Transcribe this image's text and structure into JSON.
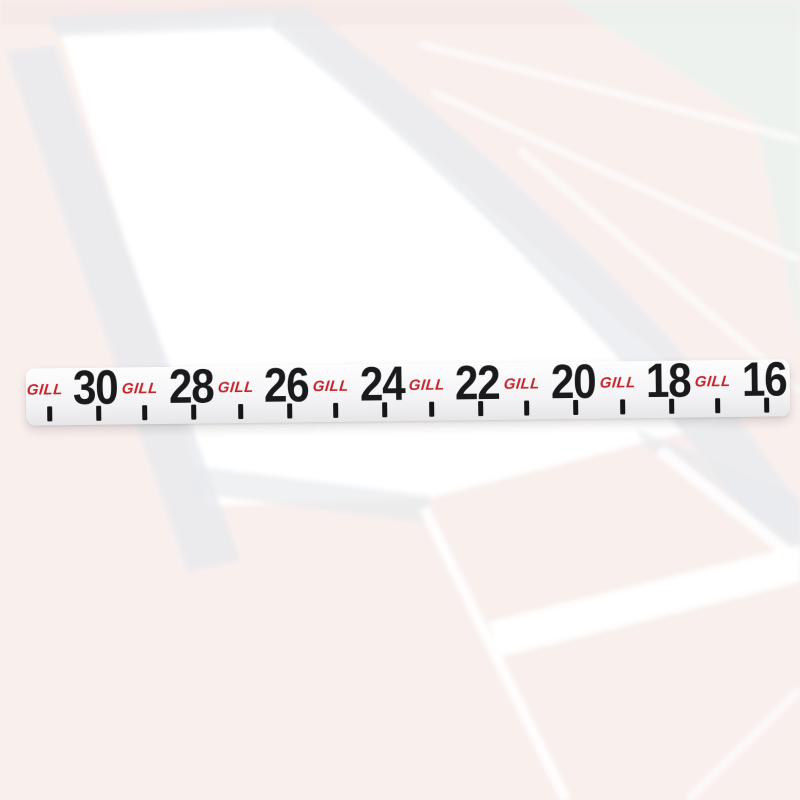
{
  "tape": {
    "brand_label": "GILL",
    "unit_sequence": [
      "30",
      "28",
      "26",
      "24",
      "22",
      "20",
      "18",
      "16"
    ],
    "segments": [
      {
        "brand": "GILL",
        "number": "30"
      },
      {
        "brand": "GILL",
        "number": "28"
      },
      {
        "brand": "GILL",
        "number": "26"
      },
      {
        "brand": "GILL",
        "number": "24"
      },
      {
        "brand": "GILL",
        "number": "22"
      },
      {
        "brand": "GILL",
        "number": "20"
      },
      {
        "brand": "GILL",
        "number": "18"
      },
      {
        "brand": "GILL",
        "number": "16"
      }
    ]
  },
  "colors": {
    "brand-red": "#c5242b",
    "number-black": "#1a1a1c",
    "tick-black": "#161616",
    "tape-top": "#fdfdfe",
    "tape-mid": "#f4f4f6",
    "tape-bottom": "#e6e6e9",
    "bg-base": "#f9f0ee",
    "bg-pink-strip": "#f6e9e6",
    "pit-white": "#ffffff",
    "band-gray": "#e7eaed",
    "cool-gray": "#ecf2ef",
    "lane-line-white": "#ffffff"
  }
}
